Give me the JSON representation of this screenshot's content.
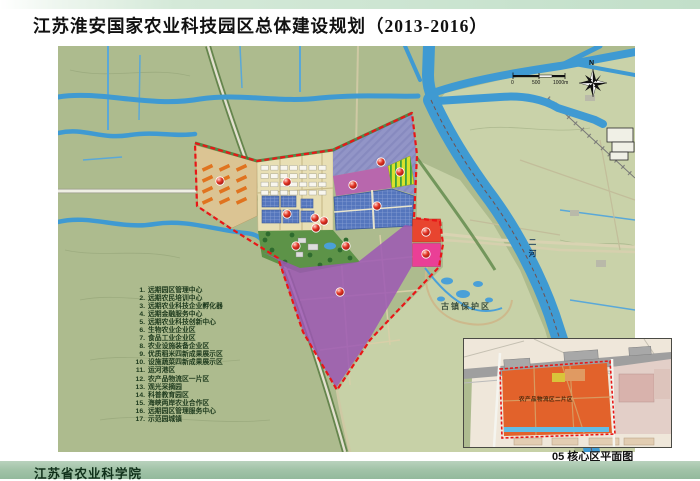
{
  "page": {
    "title": "江苏淮安国家农业科技园区总体建设规划（2013-2016）",
    "footer_org": "江苏省农业科学院",
    "caption": "05 核心区平面图"
  },
  "map": {
    "labels": {
      "ancient_town": "古镇保护区",
      "river_name": "二河",
      "compass_n": "N",
      "scale_0": "0",
      "scale_500": "500",
      "scale_1000": "1000m"
    },
    "inset": {
      "zone_label": "农产品物流区二片区"
    },
    "legend_items": [
      {
        "num": "1.",
        "label": "远期园区管理中心"
      },
      {
        "num": "2.",
        "label": "远期农民培训中心"
      },
      {
        "num": "3.",
        "label": "远期农业科技企业孵化器"
      },
      {
        "num": "4.",
        "label": "远期金融服务中心"
      },
      {
        "num": "5.",
        "label": "远期农业科技创新中心"
      },
      {
        "num": "6.",
        "label": "生物农业企业区"
      },
      {
        "num": "7.",
        "label": "食品工业企业区"
      },
      {
        "num": "8.",
        "label": "农业设施装备企业区"
      },
      {
        "num": "9.",
        "label": "优质稻米四新成果展示区"
      },
      {
        "num": "10.",
        "label": "设施蔬菜四新成果展示区"
      },
      {
        "num": "11.",
        "label": "运河港区"
      },
      {
        "num": "12.",
        "label": "农产品物流区一片区"
      },
      {
        "num": "13.",
        "label": "观光采摘园"
      },
      {
        "num": "14.",
        "label": "科普教育园区"
      },
      {
        "num": "15.",
        "label": "海峡两岸农业合作区"
      },
      {
        "num": "16.",
        "label": "远期园区管理服务中心"
      },
      {
        "num": "17.",
        "label": "示范园城镇"
      }
    ],
    "colors": {
      "land": "#adbb8e",
      "land_light": "#c9d2a9",
      "water": "#3f9ad2",
      "boundary": "#e81717",
      "zone_tan": "#dbc493",
      "zone_beige": "#e8dfb4",
      "zone_lavender": "#9295c7",
      "zone_pinkband": "#b95fb0",
      "zone_yellow": "#d9e12b",
      "zone_bluegrid": "#5576bd",
      "zone_park": "#5d9348",
      "zone_purple": "#9c57b4",
      "zone_red": "#e8452f",
      "zone_pink": "#ea3f96",
      "inset_orange": "#e2622b",
      "footer_band": "#a3c4a9"
    }
  }
}
